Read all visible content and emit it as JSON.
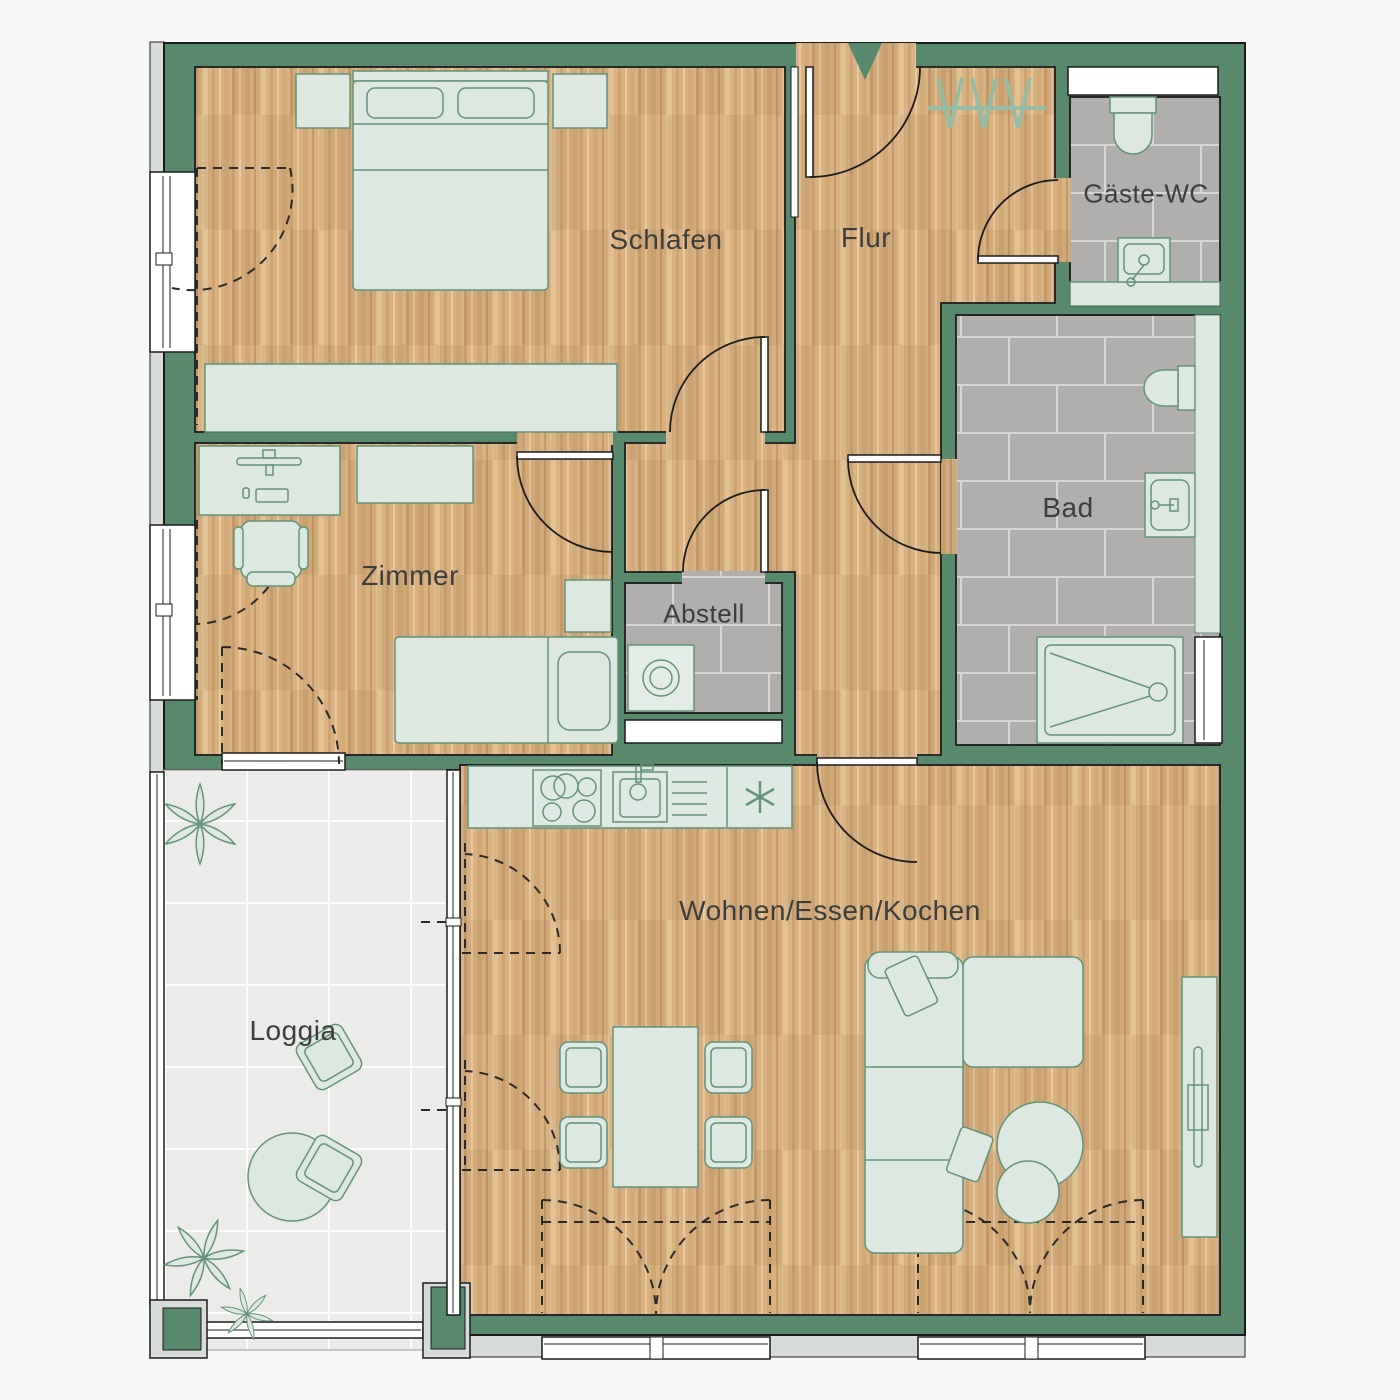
{
  "plan": {
    "rooms": {
      "schlafen": "Schlafen",
      "flur": "Flur",
      "gaeste_wc": "Gäste-WC",
      "bad": "Bad",
      "zimmer": "Zimmer",
      "abstell": "Abstell",
      "wohnen_essen_kochen": "Wohnen/Essen/Kochen",
      "loggia": "Loggia"
    },
    "colors": {
      "wall_green": "#57896c",
      "wood_base": "#d9b183",
      "tile_gray": "#b1afad",
      "loggia_tile": "#ebebe9",
      "furniture_fill": "#dde8e1",
      "furniture_stroke": "#639379",
      "label_text": "#3d3d3d",
      "exterior_trim": "#d7dcd8",
      "background": "#f7f7f6"
    }
  }
}
